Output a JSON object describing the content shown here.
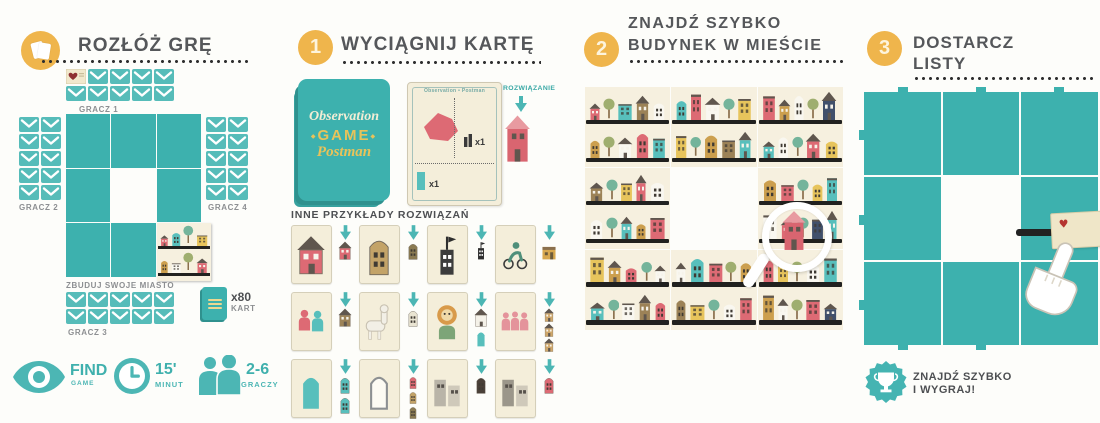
{
  "symbols": {
    "heart": "♥",
    "ornament": "◆"
  },
  "colors": {
    "teal": "#4cb6b4",
    "tile_teal": "#3db1ae",
    "orange": "#efb54c",
    "title_gray": "#55575a",
    "label_gray": "#8d9092",
    "cream": "#f4eeda",
    "pink": "#dd6a74"
  },
  "panels": {
    "setup": {
      "title": "ROZŁÓŻ GRĘ",
      "board_label": "ZBUDUJ SWOJE MIASTO",
      "deck_count": "x80",
      "deck_unit": "KART",
      "players": [
        {
          "id": "gracz1",
          "label": "GRACZ 1",
          "cols": 5,
          "rows": 2,
          "heart": true
        },
        {
          "id": "gracz2",
          "label": "GRACZ 2",
          "cols": 2,
          "rows": 5
        },
        {
          "id": "gracz4",
          "label": "GRACZ 4",
          "cols": 2,
          "rows": 5
        },
        {
          "id": "gracz3",
          "label": "GRACZ 3",
          "cols": 5,
          "rows": 2
        }
      ],
      "stats": [
        {
          "icon": "eye-icon",
          "value": "FIND",
          "unit": "GAME"
        },
        {
          "icon": "clock-icon",
          "value": "15'",
          "unit": "MINUT"
        },
        {
          "icon": "players-icon",
          "value": "2-6",
          "unit": "GRACZY"
        }
      ]
    },
    "step1": {
      "number": "1",
      "title": "WYCIĄGNIJ KARTĘ",
      "deck": {
        "line1": "Observation",
        "line2": "GAME",
        "line3": "Postman"
      },
      "card": {
        "header": "Observation • Postman",
        "count1": "x1",
        "count2": "x1"
      },
      "solution_label": "ROZWIĄZANIE",
      "examples_title": "INNE PRZYKŁADY ROZWIĄZAŃ",
      "examples": [
        {
          "card": {
            "type": "house",
            "color": "#dd6a74"
          },
          "sol": [
            {
              "type": "house",
              "color": "#dd6a74"
            }
          ]
        },
        {
          "card": {
            "type": "tower",
            "color": "#c3a368"
          },
          "sol": [
            {
              "type": "tower",
              "color": "#8a7a52"
            }
          ]
        },
        {
          "card": {
            "type": "flaghouse",
            "color": "#3c3c3c"
          },
          "sol": [
            {
              "type": "flaghouse",
              "color": "#2e2e2e"
            }
          ]
        },
        {
          "card": {
            "type": "cyclist",
            "color": "#4f8f7a"
          },
          "sol": [
            {
              "type": "shop",
              "color": "#d8a84e"
            }
          ]
        },
        {
          "card": {
            "type": "pair",
            "color": "#dd6a74",
            "color2": "#58bfbc"
          },
          "sol": [
            {
              "type": "house",
              "color": "#9c8257"
            }
          ]
        },
        {
          "card": {
            "type": "llama",
            "color": "#f2efe6"
          },
          "sol": [
            {
              "type": "tower",
              "color": "#e9e4d2"
            }
          ]
        },
        {
          "card": {
            "type": "lion",
            "color": "#d89a4a"
          },
          "sol": [
            {
              "type": "house",
              "color": "#f4f1e8"
            },
            {
              "type": "arch",
              "color": "#58bfbc"
            }
          ]
        },
        {
          "card": {
            "type": "trio",
            "color": "#e4939b"
          },
          "sol": [
            {
              "type": "house",
              "color": "#cfa76a"
            },
            {
              "type": "house",
              "color": "#cfa76a"
            },
            {
              "type": "house",
              "color": "#cfa76a"
            }
          ]
        },
        {
          "card": {
            "type": "arch",
            "color": "#58bfbc"
          },
          "sol": [
            {
              "type": "tower",
              "color": "#58bfbc"
            },
            {
              "type": "tower",
              "color": "#58bfbc"
            }
          ]
        },
        {
          "card": {
            "type": "archOutline",
            "color": "#8d9092"
          },
          "sol": [
            {
              "type": "tower",
              "color": "#dd6a74"
            },
            {
              "type": "tower",
              "color": "#c3a368"
            },
            {
              "type": "tower",
              "color": "#8a7a52"
            }
          ]
        },
        {
          "card": {
            "type": "rects",
            "color": "#b9b4a8"
          },
          "sol": [
            {
              "type": "tower",
              "color": "#4a4038"
            }
          ]
        },
        {
          "card": {
            "type": "rects",
            "color": "#9b968a"
          },
          "sol": [
            {
              "type": "tower",
              "color": "#dd6a74"
            }
          ]
        }
      ]
    },
    "step2": {
      "number": "2",
      "title_line1": "ZNAJDŹ SZYBKO",
      "title_line2": "BUDYNEK W MIEŚCIE"
    },
    "step3": {
      "number": "3",
      "title_line1": "DOSTARCZ",
      "title_line2": "LISTY",
      "win_line1": "ZNAJDŹ SZYBKO",
      "win_line2": "I WYGRAJ!"
    }
  },
  "city": {
    "palette": {
      "p": "#dd6a74",
      "t": "#58bfbc",
      "y": "#e7c45c",
      "m": "#cc9f4e",
      "b": "#9c8257",
      "w": "#f9f7f0",
      "n": "#41506b",
      "g": "#b0aa9c"
    },
    "tiles": [
      {
        "pos": "r1c1",
        "bands": [
          "p T t b w",
          "m T w p t"
        ]
      },
      {
        "pos": "r1c2",
        "bands": [
          "t p w T y",
          "y T m b t"
        ]
      },
      {
        "pos": "r1c3",
        "bands": [
          "p m w T n",
          "t w T p y"
        ]
      },
      {
        "pos": "r2c1",
        "bands": [
          "b T y p w",
          "w T t m p"
        ]
      },
      {
        "pos": "r2c3",
        "bands": [
          "m p T y t",
          "w p T n t"
        ]
      },
      {
        "pos": "r3c1",
        "bands": [
          "y m p T w",
          "t T w b p"
        ]
      },
      {
        "pos": "r3c2",
        "bands": [
          "w t p T m",
          "b y T w p"
        ]
      },
      {
        "pos": "r3c3",
        "bands": [
          "p y T w t",
          "m w T p n"
        ]
      }
    ],
    "mini_bands": [
      "p t y",
      "m w p"
    ]
  }
}
